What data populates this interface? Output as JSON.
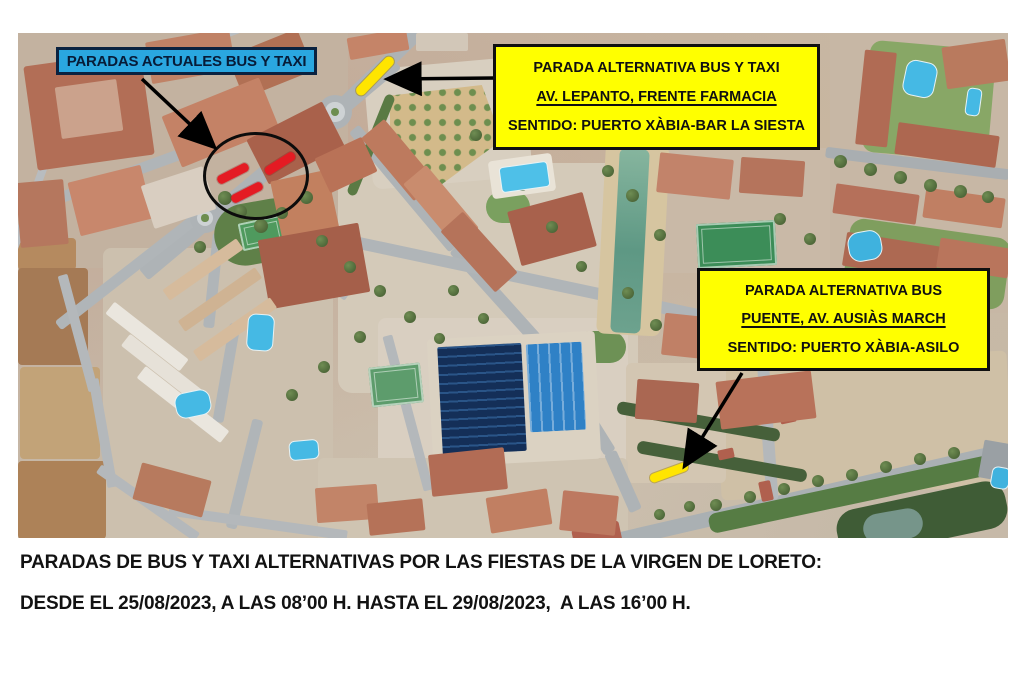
{
  "annotations": {
    "current_stops_label": "PARADAS ACTUALES BUS Y TAXI",
    "alt_stop_1": {
      "title": "PARADA ALTERNATIVA BUS Y TAXI",
      "location": "AV. LEPANTO, FRENTE FARMACIA",
      "direction": "SENTIDO: PUERTO XÀBIA-BAR LA SIESTA"
    },
    "alt_stop_2": {
      "title": "PARADA ALTERNATIVA BUS",
      "location": "PUENTE, AV. AUSIÀS MARCH",
      "direction": "SENTIDO: PUERTO XÀBIA-ASILO"
    }
  },
  "footer": {
    "line1": "PARADAS DE BUS Y TAXI ALTERNATIVAS POR LAS FIESTAS DE LA VIRGEN DE LORETO:",
    "line2": "DESDE EL 25/08/2023, A LAS 08’00 H. HASTA EL 29/08/2023,  A LAS 16’00 H."
  },
  "colors": {
    "label_blue": "#2aa7e0",
    "label_yellow": "#ffff00",
    "marker_red": "#e41b23",
    "marker_yellow": "#ffe500",
    "annotation_black": "#000000"
  }
}
